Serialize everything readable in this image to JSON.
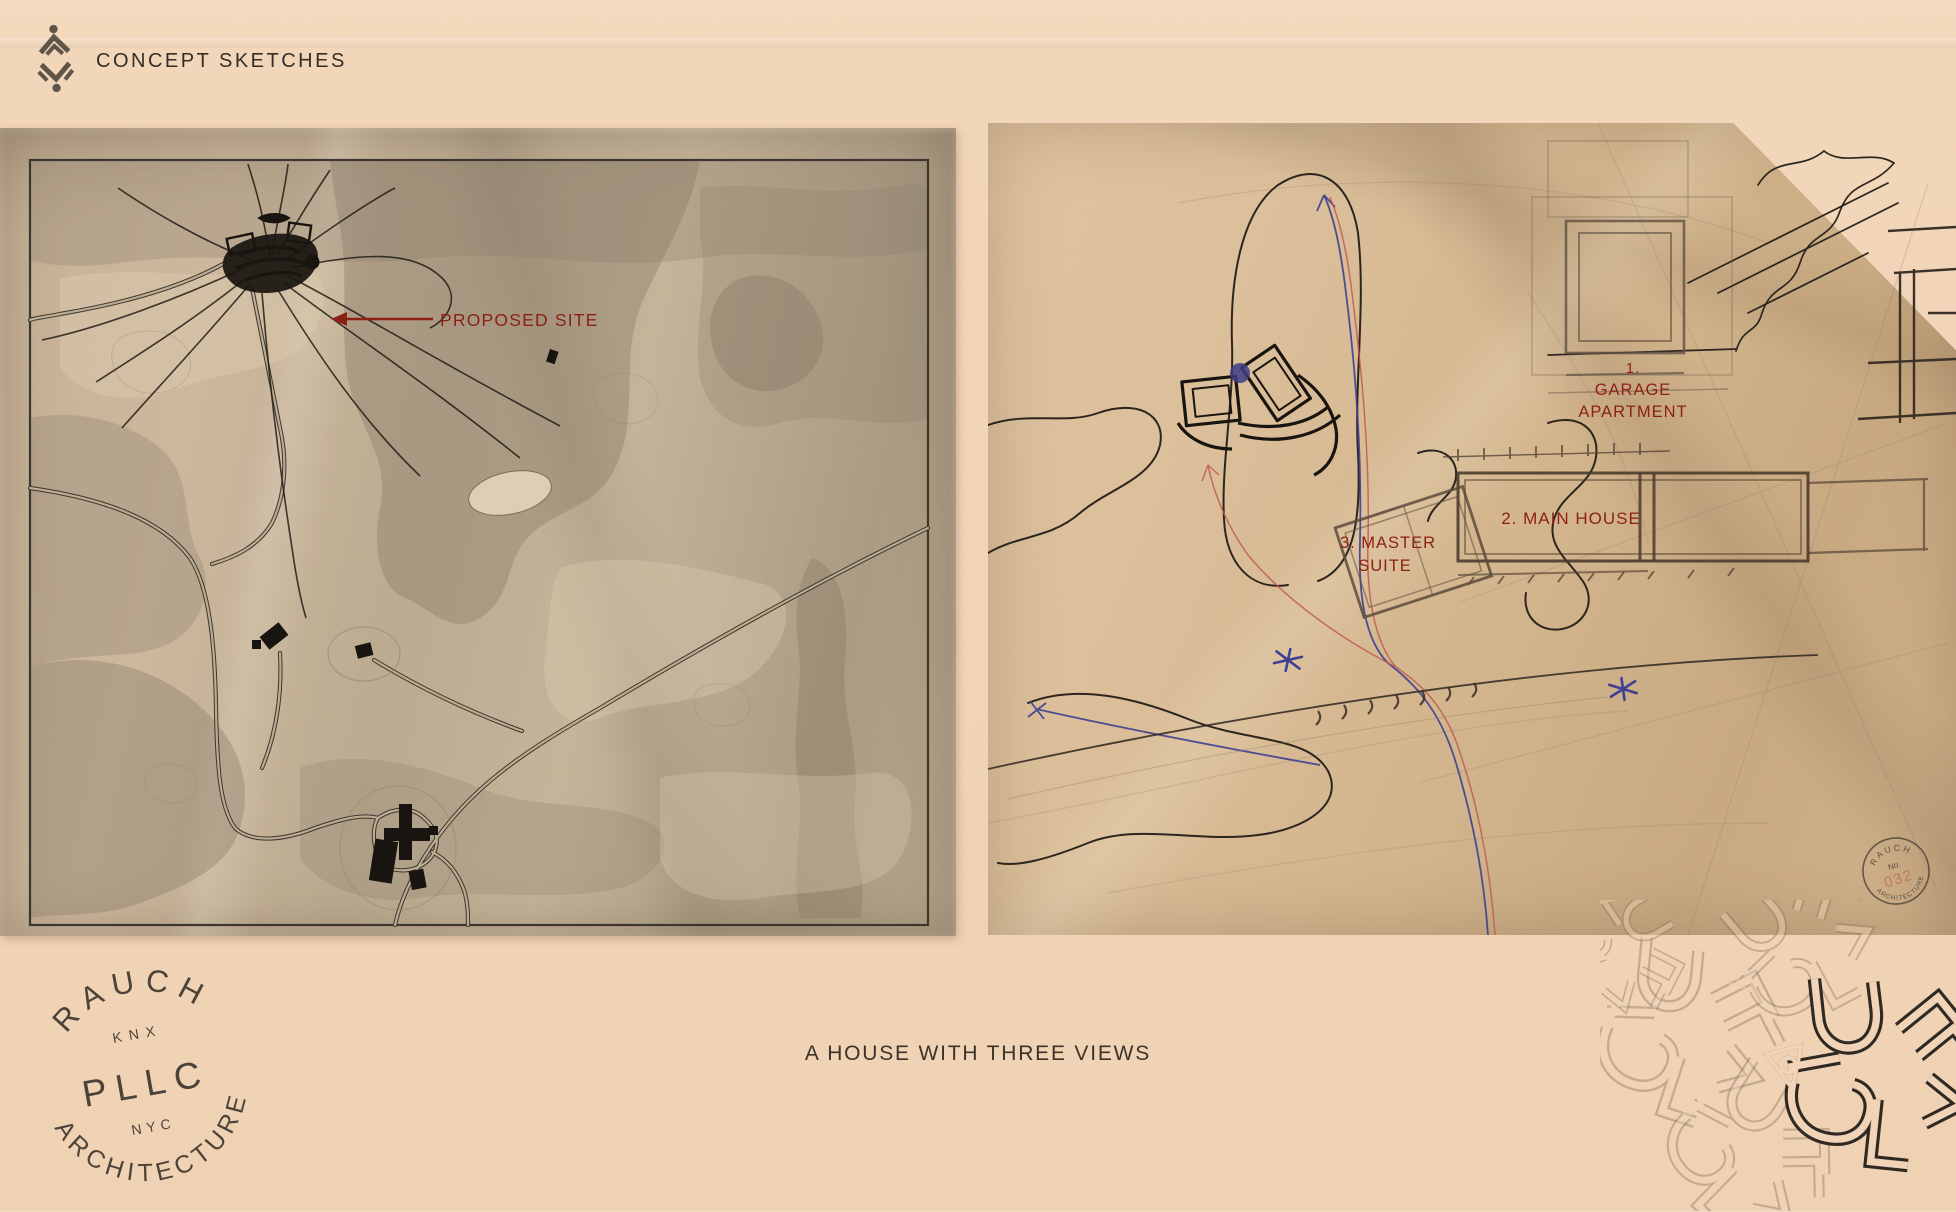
{
  "header": {
    "label": "CONCEPT SKETCHES"
  },
  "footer": {
    "title": "A HOUSE WITH THREE VIEWS"
  },
  "left_sketch": {
    "proposed_site_label": "PROPOSED SITE"
  },
  "right_sketch": {
    "garage_no": "1.",
    "garage_line1": "GARAGE",
    "garage_line2": "APARTMENT",
    "main_house_label": "2. MAIN HOUSE",
    "master_line1": "3. MASTER",
    "master_line2": "SUITE",
    "stamp_top": "RAUCH",
    "stamp_no_label": "No.",
    "stamp_number": "032",
    "stamp_bottom": "ARCHITECTURE"
  },
  "studio_stamp": {
    "arc_top": "RAUCH",
    "knx": "KNX",
    "pllc": "PLLC",
    "nyc": "NYC",
    "arc_bottom": "ARCHITECTURE"
  },
  "colors": {
    "background_paper": "#f2d5b8",
    "left_paper": "#c2ad93",
    "right_paper": "#d6ba93",
    "label_red": "#8c1f12",
    "ink": "#332c25",
    "blue_pen": "#3e3e92",
    "red_pen": "#c05a50",
    "pencil": "#8f7c66",
    "stamp_ink": "#3a332b"
  }
}
